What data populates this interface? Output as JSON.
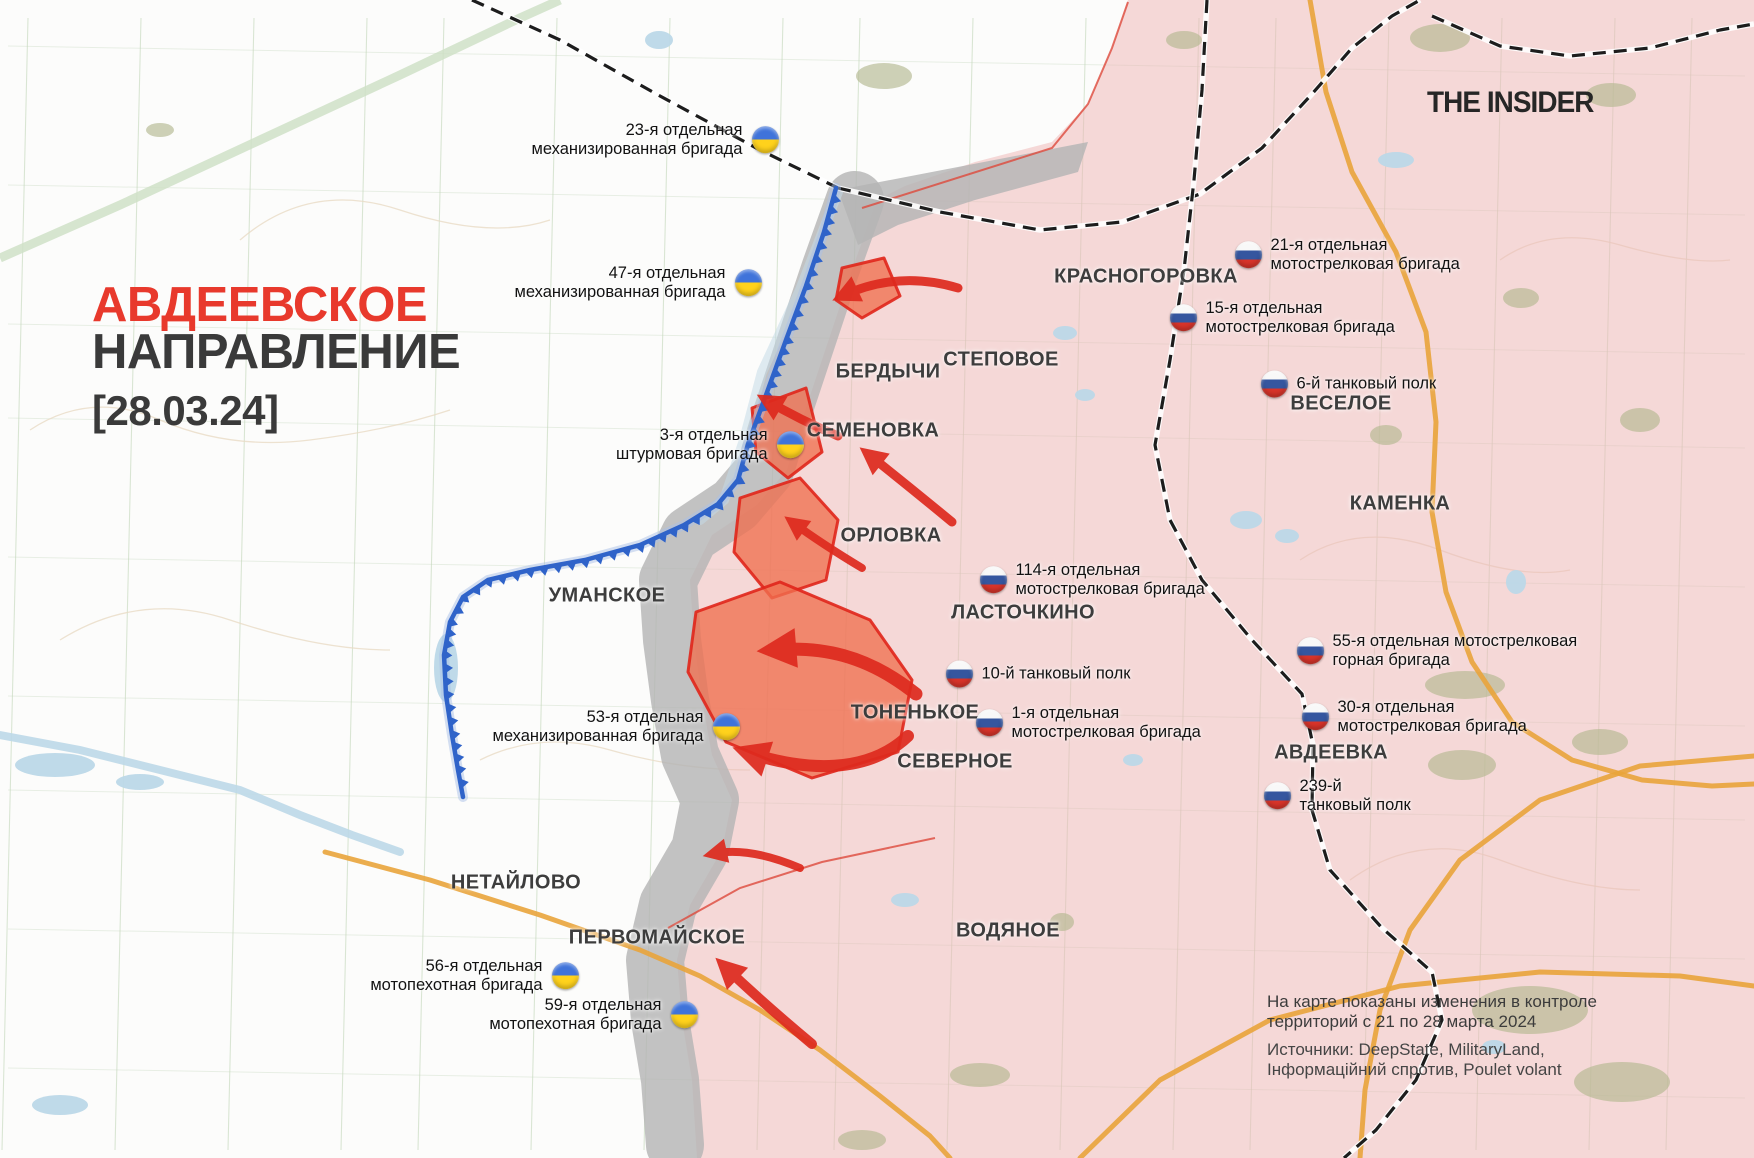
{
  "brand": "THE INSIDER",
  "title": {
    "line1": "АВДЕЕВСКОЕ",
    "line2": "НАПРАВЛЕНИЕ",
    "date": "[28.03.24]"
  },
  "legend": {
    "l1": "На карте показаны изменения в контроле",
    "l2": "территорий с 21 по 28 марта 2024",
    "l3": "Источники: DeepState, MilitaryLand,",
    "l4": "Інформаційний спротив, Poulet volant"
  },
  "colors": {
    "title_red": "#e8392c",
    "text_dark": "#3a3a3a",
    "russia_control_fill": "#f7dada",
    "contested_gray": "#b4b4b4",
    "captured_week_fill": "#ef6f50",
    "captured_week_border": "#e0261b",
    "front_line_blue": "#2f63c9",
    "attack_arrow_red": "#de2a1e",
    "ua_flag": [
      "#3f73da",
      "#ffd21c"
    ],
    "ru_flag": [
      "#f8f8f8",
      "#35569f",
      "#d8342a"
    ]
  },
  "towns": [
    {
      "name": "КРАСНОГОРОВКА",
      "x": 1146,
      "y": 277
    },
    {
      "name": "СТЕПОВОЕ",
      "x": 1001,
      "y": 360
    },
    {
      "name": "БЕРДЫЧИ",
      "x": 888,
      "y": 372
    },
    {
      "name": "СЕМЕНОВКА",
      "x": 873,
      "y": 431
    },
    {
      "name": "ОРЛОВКА",
      "x": 891,
      "y": 536
    },
    {
      "name": "ВЕСЕЛОЕ",
      "x": 1341,
      "y": 404
    },
    {
      "name": "КАМЕНКА",
      "x": 1400,
      "y": 504
    },
    {
      "name": "УМАНСКОЕ",
      "x": 607,
      "y": 596
    },
    {
      "name": "ЛАСТОЧКИНО",
      "x": 1023,
      "y": 613
    },
    {
      "name": "ТОНЕНЬКОЕ",
      "x": 915,
      "y": 713
    },
    {
      "name": "СЕВЕРНОЕ",
      "x": 955,
      "y": 762
    },
    {
      "name": "АВДЕЕВКА",
      "x": 1331,
      "y": 753
    },
    {
      "name": "НЕТАЙЛОВО",
      "x": 516,
      "y": 883
    },
    {
      "name": "ПЕРВОМАЙСКОЕ",
      "x": 657,
      "y": 938
    },
    {
      "name": "ВОДЯНОЕ",
      "x": 1008,
      "y": 931
    }
  ],
  "units": [
    {
      "army": "ua",
      "lines": [
        "23-я отдельная",
        "механизированная бригада"
      ],
      "x": 765,
      "y": 140
    },
    {
      "army": "ua",
      "lines": [
        "47-я отдельная",
        "механизированная бригада"
      ],
      "x": 748,
      "y": 283
    },
    {
      "army": "ua",
      "lines": [
        "3-я отдельная",
        "штурмовая бригада"
      ],
      "x": 790,
      "y": 445
    },
    {
      "army": "ua",
      "lines": [
        "53-я отдельная",
        "механизированная бригада"
      ],
      "x": 726,
      "y": 727
    },
    {
      "army": "ua",
      "lines": [
        "56-я отдельная",
        "мотопехотная бригада"
      ],
      "x": 565,
      "y": 976
    },
    {
      "army": "ua",
      "lines": [
        "59-я отдельная",
        "мотопехотная бригада"
      ],
      "x": 684,
      "y": 1015
    },
    {
      "army": "ru",
      "lines": [
        "21-я отдельная",
        "мотострелковая бригада"
      ],
      "x": 1248,
      "y": 255
    },
    {
      "army": "ru",
      "lines": [
        "15-я отдельная",
        "мотострелковая бригада"
      ],
      "x": 1183,
      "y": 318
    },
    {
      "army": "ru",
      "lines": [
        "6-й танковый полк"
      ],
      "x": 1274,
      "y": 384
    },
    {
      "army": "ru",
      "lines": [
        "114-я отдельная",
        "мотострелковая бригада"
      ],
      "x": 993,
      "y": 580
    },
    {
      "army": "ru",
      "lines": [
        "10-й танковый полк"
      ],
      "x": 959,
      "y": 674
    },
    {
      "army": "ru",
      "lines": [
        "1-я отдельная",
        "мотострелковая бригада"
      ],
      "x": 989,
      "y": 723
    },
    {
      "army": "ru",
      "lines": [
        "55-я отдельная мотострелковая",
        "горная бригада"
      ],
      "x": 1310,
      "y": 651
    },
    {
      "army": "ru",
      "lines": [
        "30-я отдельная",
        "мотострелковая бригада"
      ],
      "x": 1315,
      "y": 717
    },
    {
      "army": "ru",
      "lines": [
        "239-й",
        "танковый полк"
      ],
      "x": 1277,
      "y": 796
    }
  ],
  "map": {
    "front_line": [
      [
        836,
        188
      ],
      [
        824,
        232
      ],
      [
        806,
        286
      ],
      [
        786,
        340
      ],
      [
        766,
        395
      ],
      [
        748,
        444
      ],
      [
        738,
        480
      ],
      [
        718,
        504
      ],
      [
        684,
        525
      ],
      [
        640,
        545
      ],
      [
        585,
        560
      ],
      [
        530,
        570
      ],
      [
        488,
        580
      ],
      [
        463,
        597
      ],
      [
        450,
        622
      ],
      [
        444,
        655
      ],
      [
        446,
        695
      ],
      [
        452,
        735
      ],
      [
        458,
        770
      ],
      [
        463,
        797
      ]
    ],
    "russia_area": [
      [
        1128,
        0
      ],
      [
        1112,
        48
      ],
      [
        1088,
        104
      ],
      [
        1052,
        142
      ],
      [
        975,
        162
      ],
      [
        905,
        186
      ],
      [
        877,
        200
      ],
      [
        852,
        270
      ],
      [
        827,
        345
      ],
      [
        802,
        420
      ],
      [
        787,
        470
      ],
      [
        757,
        505
      ],
      [
        712,
        535
      ],
      [
        690,
        580
      ],
      [
        694,
        640
      ],
      [
        702,
        700
      ],
      [
        712,
        755
      ],
      [
        732,
        800
      ],
      [
        722,
        850
      ],
      [
        690,
        905
      ],
      [
        677,
        960
      ],
      [
        682,
        1020
      ],
      [
        692,
        1080
      ],
      [
        697,
        1158
      ],
      [
        1754,
        1158
      ],
      [
        1754,
        0
      ]
    ],
    "gray_band": [
      [
        855,
        200
      ],
      [
        830,
        270
      ],
      [
        805,
        345
      ],
      [
        780,
        420
      ],
      [
        765,
        470
      ],
      [
        735,
        505
      ],
      [
        690,
        535
      ],
      [
        668,
        580
      ],
      [
        672,
        640
      ],
      [
        680,
        700
      ],
      [
        690,
        755
      ],
      [
        710,
        800
      ],
      [
        700,
        850
      ],
      [
        668,
        905
      ],
      [
        655,
        960
      ],
      [
        660,
        1020
      ],
      [
        670,
        1080
      ],
      [
        675,
        1145
      ]
    ],
    "gray_wedge": [
      [
        838,
        190
      ],
      [
        1088,
        142
      ],
      [
        1078,
        172
      ],
      [
        975,
        200
      ],
      [
        898,
        225
      ],
      [
        858,
        245
      ]
    ],
    "captured_polygons": [
      [
        [
          842,
          268
        ],
        [
          884,
          258
        ],
        [
          900,
          296
        ],
        [
          862,
          318
        ],
        [
          836,
          300
        ]
      ],
      [
        [
          752,
          408
        ],
        [
          806,
          388
        ],
        [
          822,
          452
        ],
        [
          788,
          478
        ],
        [
          756,
          452
        ]
      ],
      [
        [
          740,
          498
        ],
        [
          800,
          478
        ],
        [
          838,
          520
        ],
        [
          826,
          580
        ],
        [
          772,
          598
        ],
        [
          734,
          552
        ]
      ],
      [
        [
          696,
          612
        ],
        [
          780,
          582
        ],
        [
          870,
          620
        ],
        [
          912,
          680
        ],
        [
          898,
          752
        ],
        [
          812,
          778
        ],
        [
          726,
          742
        ],
        [
          688,
          672
        ]
      ]
    ],
    "attack_arrows": [
      {
        "d": "M958,288 Q898,270 842,296",
        "w": 9
      },
      {
        "d": "M838,436 Q800,420 766,400",
        "w": 9
      },
      {
        "d": "M952,522 Q906,484 868,454",
        "w": 9
      },
      {
        "d": "M862,568 Q822,544 792,522",
        "w": 8
      },
      {
        "d": "M916,694 C866,654 820,646 772,650",
        "w": 13
      },
      {
        "d": "M908,736 C868,774 806,772 746,752",
        "w": 12
      },
      {
        "d": "M800,868 Q748,846 712,854",
        "w": 8
      },
      {
        "d": "M812,1044 Q764,1004 724,966",
        "w": 10
      }
    ],
    "railways": [
      [
        [
          472,
          0
        ],
        [
          560,
          40
        ],
        [
          660,
          96
        ],
        [
          760,
          150
        ],
        [
          838,
          188
        ]
      ],
      [
        [
          838,
          188
        ],
        [
          940,
          212
        ],
        [
          1040,
          230
        ],
        [
          1122,
          222
        ],
        [
          1200,
          194
        ],
        [
          1262,
          148
        ],
        [
          1312,
          94
        ],
        [
          1352,
          48
        ],
        [
          1392,
          16
        ],
        [
          1420,
          0
        ]
      ],
      [
        [
          1432,
          16
        ],
        [
          1500,
          46
        ],
        [
          1570,
          56
        ],
        [
          1650,
          48
        ],
        [
          1720,
          30
        ],
        [
          1754,
          24
        ]
      ],
      [
        [
          1207,
          0
        ],
        [
          1202,
          90
        ],
        [
          1194,
          180
        ],
        [
          1184,
          270
        ],
        [
          1170,
          360
        ],
        [
          1155,
          445
        ],
        [
          1170,
          520
        ],
        [
          1202,
          580
        ],
        [
          1252,
          640
        ],
        [
          1302,
          694
        ],
        [
          1313,
          745
        ],
        [
          1312,
          810
        ],
        [
          1330,
          870
        ],
        [
          1382,
          928
        ],
        [
          1432,
          972
        ],
        [
          1442,
          1020
        ],
        [
          1416,
          1080
        ],
        [
          1376,
          1130
        ],
        [
          1344,
          1158
        ]
      ]
    ],
    "roads": [
      [
        [
          1310,
          0
        ],
        [
          1326,
          92
        ],
        [
          1352,
          172
        ],
        [
          1396,
          252
        ],
        [
          1426,
          332
        ],
        [
          1436,
          422
        ],
        [
          1432,
          512
        ],
        [
          1446,
          592
        ],
        [
          1472,
          662
        ],
        [
          1512,
          722
        ],
        [
          1572,
          760
        ],
        [
          1642,
          780
        ],
        [
          1712,
          786
        ],
        [
          1754,
          784
        ]
      ],
      [
        [
          1754,
          756
        ],
        [
          1640,
          766
        ],
        [
          1540,
          800
        ],
        [
          1460,
          860
        ],
        [
          1410,
          930
        ],
        [
          1380,
          1010
        ],
        [
          1365,
          1090
        ],
        [
          1360,
          1158
        ]
      ],
      [
        [
          1080,
          1158
        ],
        [
          1160,
          1080
        ],
        [
          1270,
          1020
        ],
        [
          1400,
          986
        ],
        [
          1540,
          972
        ],
        [
          1680,
          976
        ],
        [
          1754,
          986
        ]
      ],
      [
        [
          325,
          852
        ],
        [
          430,
          880
        ],
        [
          540,
          915
        ],
        [
          640,
          950
        ],
        [
          700,
          976
        ],
        [
          760,
          1010
        ],
        [
          820,
          1050
        ],
        [
          880,
          1096
        ],
        [
          930,
          1136
        ],
        [
          950,
          1158
        ]
      ]
    ],
    "green_band": [
      [
        0,
        258
      ],
      [
        120,
        205
      ],
      [
        260,
        140
      ],
      [
        400,
        75
      ],
      [
        520,
        18
      ],
      [
        560,
        0
      ]
    ],
    "red_boundaries": [
      [
        [
          862,
          208
        ],
        [
          1052,
          148
        ],
        [
          1088,
          104
        ],
        [
          1112,
          48
        ],
        [
          1128,
          2
        ]
      ],
      [
        [
          668,
          928
        ],
        [
          740,
          888
        ],
        [
          822,
          862
        ],
        [
          935,
          838
        ]
      ]
    ],
    "rivers": [
      [
        [
          0,
          735
        ],
        [
          80,
          750
        ],
        [
          160,
          770
        ],
        [
          240,
          790
        ],
        [
          300,
          815
        ],
        [
          352,
          835
        ],
        [
          400,
          852
        ]
      ],
      [
        [
          838,
          192
        ],
        [
          800,
          290
        ],
        [
          762,
          372
        ],
        [
          744,
          440
        ],
        [
          724,
          500
        ],
        [
          700,
          520
        ]
      ]
    ],
    "water": [
      [
        659,
        40,
        14,
        9
      ],
      [
        1396,
        160,
        18,
        8
      ],
      [
        1065,
        333,
        12,
        7
      ],
      [
        1085,
        395,
        10,
        6
      ],
      [
        1246,
        520,
        16,
        9
      ],
      [
        1287,
        536,
        12,
        7
      ],
      [
        1516,
        582,
        10,
        12
      ],
      [
        1133,
        760,
        10,
        6
      ],
      [
        1494,
        1047,
        12,
        7
      ],
      [
        446,
        668,
        12,
        34
      ],
      [
        55,
        765,
        40,
        12
      ],
      [
        140,
        782,
        24,
        8
      ],
      [
        60,
        1105,
        28,
        10
      ],
      [
        905,
        900,
        14,
        7
      ]
    ],
    "forests": [
      [
        884,
        76,
        28,
        13
      ],
      [
        1440,
        38,
        30,
        14
      ],
      [
        1611,
        95,
        25,
        12
      ],
      [
        1386,
        435,
        16,
        10
      ],
      [
        1521,
        298,
        18,
        10
      ],
      [
        1640,
        420,
        20,
        12
      ],
      [
        1465,
        685,
        40,
        14
      ],
      [
        1462,
        765,
        34,
        15
      ],
      [
        1600,
        742,
        28,
        13
      ],
      [
        1062,
        922,
        12,
        9
      ],
      [
        1530,
        1010,
        58,
        24
      ],
      [
        1622,
        1082,
        48,
        20
      ],
      [
        980,
        1075,
        30,
        12
      ],
      [
        862,
        1140,
        24,
        10
      ],
      [
        160,
        130,
        14,
        7
      ],
      [
        1184,
        40,
        18,
        9
      ]
    ],
    "contours": [
      "M30,430 q60,-40 130,-10 t150,20 t140,-30",
      "M60,640 q80,-50 170,-20 t160,30",
      "M240,240 q70,-60 160,-30 t150,10",
      "M1300,560 q60,-40 140,-10 t130,20",
      "M1350,880 q70,-50 150,-20 t140,30",
      "M480,760 q60,-30 130,-10 t140,20",
      "M1500,260 q50,-35 120,-15 t110,15"
    ]
  }
}
